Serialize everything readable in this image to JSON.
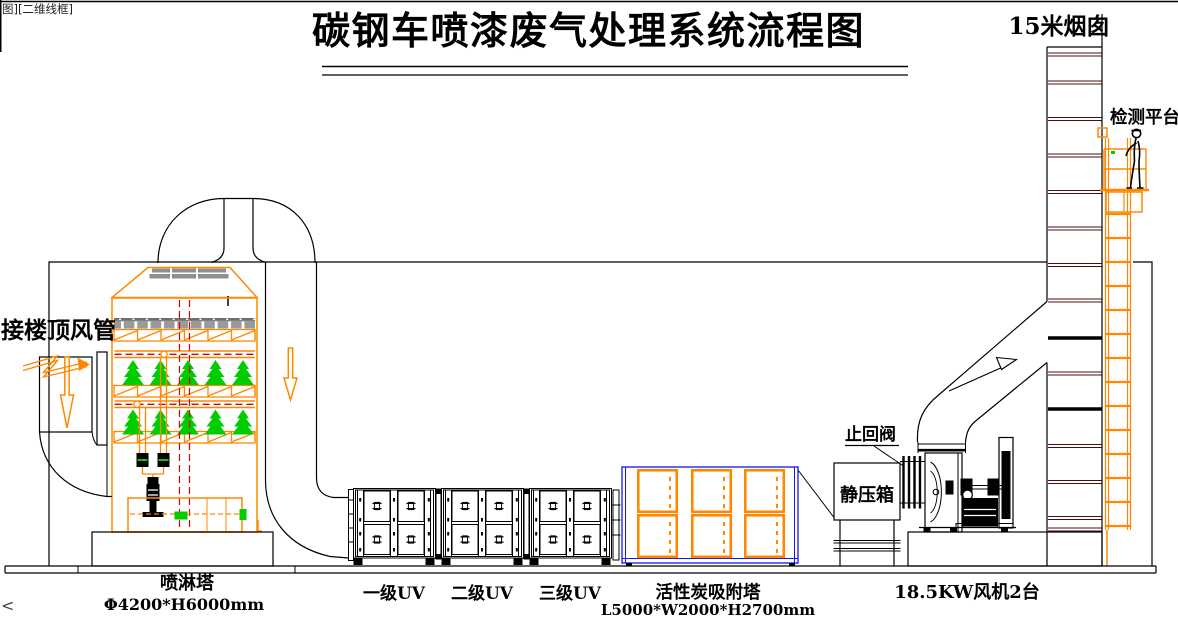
{
  "viewport_tag": "图][二维线框]",
  "title": "碳钢车喷漆废气处理系统流程图",
  "corner_mark": "<",
  "equipment": {
    "chimney": {
      "label": "15米烟囱"
    },
    "platform": {
      "label": "检测平台"
    },
    "roof_duct": {
      "label": "接楼顶风管"
    },
    "check_valve": {
      "label": "止回阀"
    },
    "plenum": {
      "label": "静压箱"
    },
    "spray_tower": {
      "label": "喷淋塔",
      "spec": "Φ4200*H6000mm"
    },
    "uv_stages": [
      {
        "label": "一级UV"
      },
      {
        "label": "二级UV"
      },
      {
        "label": "三级UV"
      }
    ],
    "carbon_tower": {
      "label": "活性炭吸附塔",
      "spec": "L5000*W2000*H2700mm"
    },
    "fan": {
      "label": "18.5KW风机2台"
    }
  },
  "colors": {
    "outline": "#000000",
    "equipment_orange": "#ff8800",
    "pipe_red": "#e00000",
    "spray_green": "#00cc00",
    "carbon_blue": "#1414e6",
    "packing_gray": "#9a9a9a",
    "chimney_flange": "#4a0d0d",
    "background": "#ffffff"
  }
}
